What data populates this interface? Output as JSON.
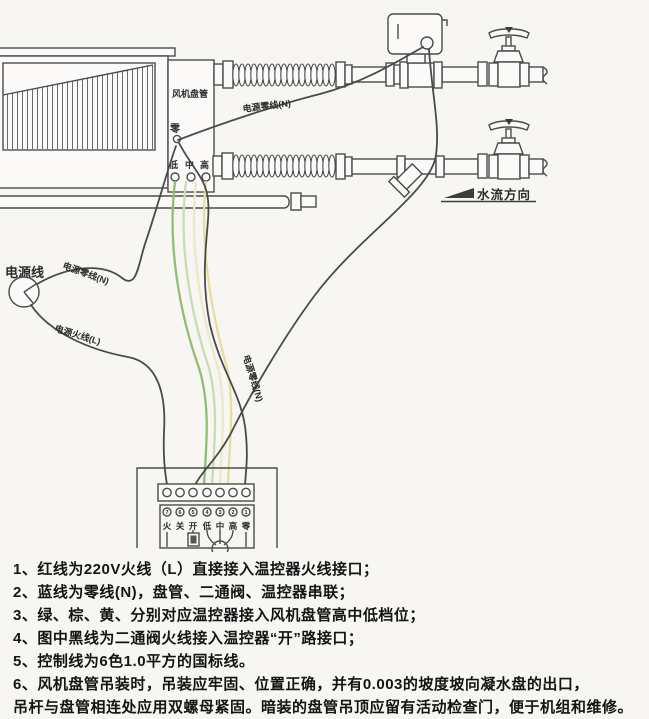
{
  "diagram": {
    "fan_coil_label": "风机盘管",
    "neutral_terminal": "零",
    "speed_terminals": [
      "低",
      "中",
      "高"
    ],
    "power_line_label": "电源线",
    "power_neutral_label_top": "电源零线(N)",
    "power_neutral_label_left": "电源零线(N)",
    "power_neutral_label_bundle": "电源零线(N)",
    "power_live_label": "电源火线(L)",
    "flow_direction_label": "水流方向",
    "thermostat": {
      "terminal_numbers": [
        "7",
        "6",
        "5",
        "4",
        "3",
        "2",
        "1"
      ],
      "terminal_labels": [
        "火",
        "关",
        "开",
        "低",
        "中",
        "高",
        "零"
      ]
    },
    "wire_colors": {
      "black": "#4a4a4a",
      "green": "#8fbe72",
      "light_green": "#c6deb2",
      "cream": "#ebe9cc",
      "yellow": "#e7dd9c"
    }
  },
  "notes": [
    "1、红线为220V火线（L）直接接入温控器火线接口；",
    "2、蓝线为零线(N)，盘管、二通阀、温控器串联；",
    "3、绿、棕、黄、分别对应温控器接入风机盘管高中低档位；",
    "4、图中黑线为二通阀火线接入温控器“开”路接口；",
    "5、控制线为6色1.0平方的国标线。",
    "6、风机盘管吊装时，吊装应牢固、位置正确，并有0.003的坡度坡向凝水盘的出口，\n吊杆与盘管相连处应用双螺母紧固。暗装的盘管吊顶应留有活动检查门，便于机组和维修。"
  ]
}
